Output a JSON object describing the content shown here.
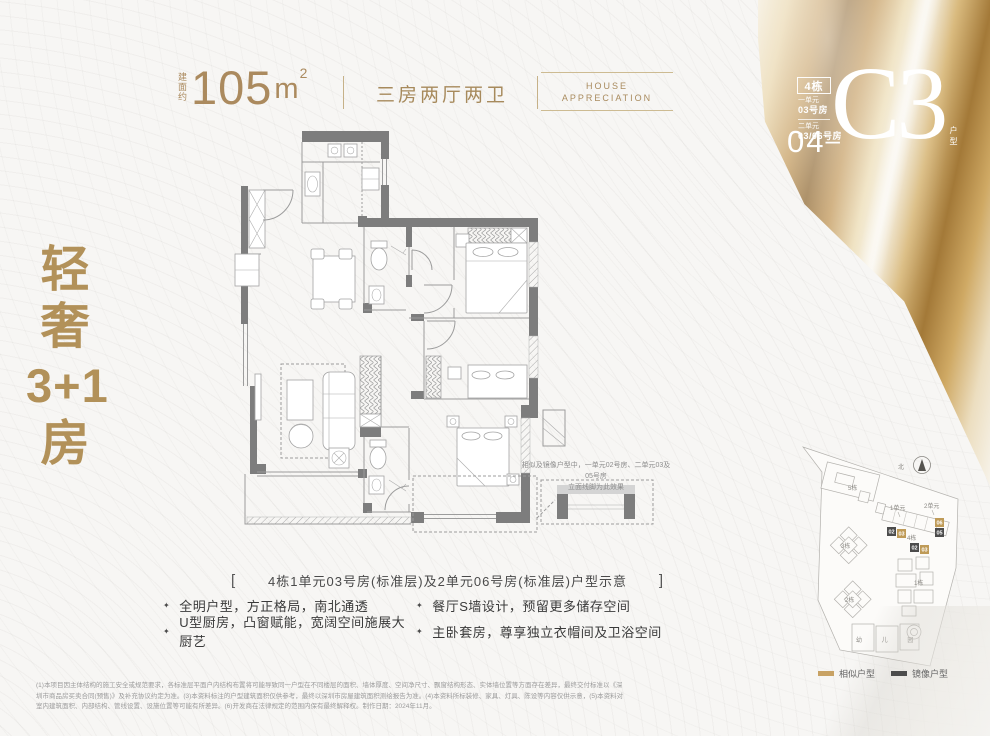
{
  "header": {
    "area_prefix": "建面约",
    "area_value": "105",
    "area_unit": "m",
    "area_exponent": "2",
    "layout_type": "三房两厅两卫",
    "brand_line1": "HOUSE",
    "brand_line2": "APPRECIATION"
  },
  "type_badge": {
    "building": "4栋",
    "unit1": "一单元",
    "unit1_room": "03号房",
    "unit2": "二单元",
    "unit2_room": "03/06号房",
    "number": "04",
    "dash": "–",
    "code": "C3",
    "code_suffix": "户型"
  },
  "slogan": {
    "line1": "轻",
    "line2": "奢",
    "line3": "3+1",
    "line4": "房"
  },
  "floor_plan": {
    "note_line1": "相似及镜像户型中，一单元02号房、二单元03及05号房",
    "note_line2": "立面线脚为此效果",
    "bracket_left": "[",
    "bracket_right": "]",
    "caption": "4栋1单元03号房(标准层)及2单元06号房(标准层)户型示意"
  },
  "features": {
    "bullet": "✦",
    "items": [
      "全明户型，方正格局，南北通透",
      "餐厅S墙设计，预留更多储存空间",
      "U型厨房，凸窗赋能，宽阔空间施展大厨艺",
      "主卧套房，尊享独立衣帽间及卫浴空间"
    ]
  },
  "site_map": {
    "north": "北",
    "buildings": {
      "b5": "5栋",
      "b3": "3栋",
      "b2": "2栋",
      "b1": "1栋",
      "b4": "4栋",
      "kindergarten": "幼 儿 园"
    },
    "units": {
      "u1": "1单元",
      "u2": "2单元"
    },
    "tags": {
      "t02a": "02",
      "t03a": "03",
      "t02b": "02",
      "t03b": "03",
      "t05": "05",
      "t06": "06"
    },
    "legend": {
      "similar": "相似户型",
      "mirror": "镜像户型"
    }
  },
  "disclaimer": {
    "line1": "(1)本项目因主体结构的施工安全或规范要求，各标准层平面户内结构布置将可能导致同一户型在不同楼层的面积、墙体厚度、空间净尺寸、飘窗结构形态、实体墙位置等方面存在差异，最终交付标准以《深",
    "line2": "圳市商品房买卖合同(预售)》及补充协议约定为准。(3)本资料标注的户型建筑面积仅供参考，最终以深圳市房屋建筑面积测绘报告为准。(4)本资料所标装修、家具、灯具、陈设等内容仅供示意，(5)本资料对",
    "line3": "室内建筑面积、内部结构、管线设置、设施位置等可能有所差异。(6)开发商在法律规定的范围内保有最终解释权。制作日期：2024年11月。"
  },
  "colors": {
    "gold_text": "#ab8a5e",
    "slogan_gold": "#b29159",
    "wall_gray": "#7d7d7d",
    "tag_similar": "#bf9b58",
    "tag_mirror": "#4c4c4c"
  }
}
